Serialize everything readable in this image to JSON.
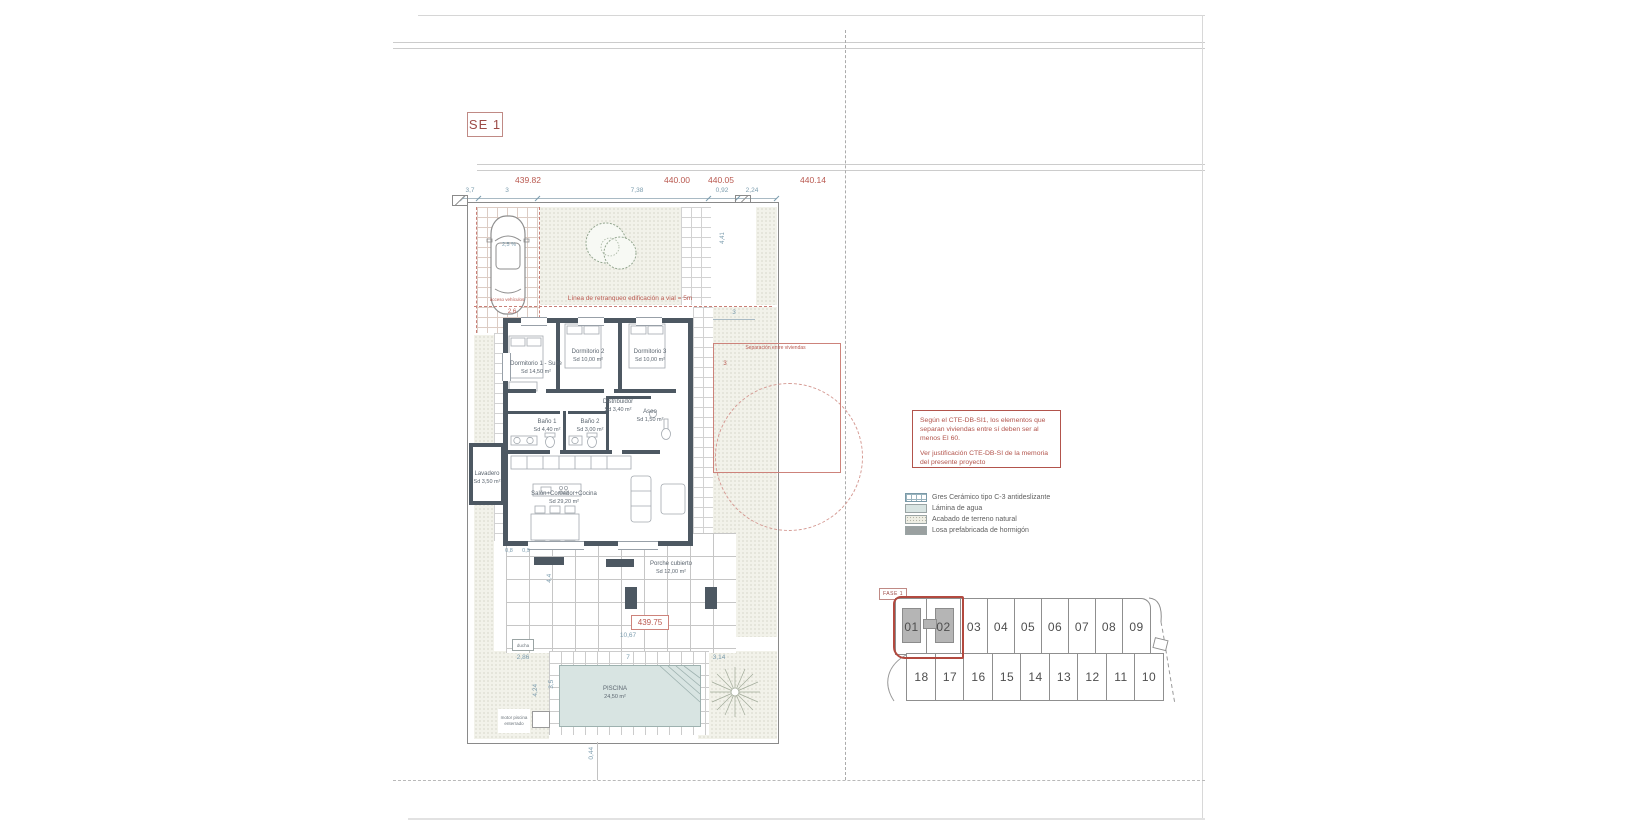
{
  "sheet": {
    "tag": "SE 1"
  },
  "dims": {
    "elevations": [
      "439.82",
      "440.00",
      "440.05",
      "440.14"
    ],
    "segments": [
      "3,7",
      "3",
      "7,38",
      "0,92",
      "2,24"
    ],
    "top_strip_height": "4,41",
    "slope_right": "4,8 %",
    "car_slope": "2,5 %",
    "car_width": "2,6",
    "offset_blue": "3",
    "offset_red": "3",
    "left_a": "0,8",
    "left_b": "0,9",
    "terrace_width": "10,67",
    "terrace_height": "4,4",
    "pool_width": "7",
    "deck_left": "2,86",
    "deck_right": "3,14",
    "pool_height": "3,5",
    "deck_height": "4,24",
    "plot_bottom": "0,44"
  },
  "annotations": {
    "retranqueo": "Línea de retranqueo edificación a vial = 5m",
    "separacion": "Separación entre viviendas",
    "acceso": "acceso vehículos",
    "terrace_level": "439.75",
    "ducha": "ducha",
    "motor": "motor piscina enterrado"
  },
  "rooms": {
    "dorm1": {
      "name": "Dormitorio 1 - Suite",
      "area": "Sd 14,50 m²"
    },
    "dorm2": {
      "name": "Dormitorio 2",
      "area": "Sd 10,00 m²"
    },
    "dorm3": {
      "name": "Dormitorio 3",
      "area": "Sd 10,00 m²"
    },
    "distribuidor": {
      "name": "Distribuidor",
      "area": "Sd 3,40 m²"
    },
    "bano1": {
      "name": "Baño 1",
      "area": "Sd 4,40 m²"
    },
    "bano2": {
      "name": "Baño 2",
      "area": "Sd 3,00 m²"
    },
    "aseo": {
      "name": "Aseo",
      "area": "Sd 1,50 m²"
    },
    "lavadero": {
      "name": "Lavadero",
      "area": "Sd 3,50 m²"
    },
    "salon": {
      "name": "Salón+Comedor+Cocina",
      "area": "Sd 29,20 m²"
    },
    "porche": {
      "name": "Porche cubierto",
      "area": "Sd 12,00 m²"
    },
    "piscina": {
      "name": "PISCINA",
      "area": "24,50 m²"
    }
  },
  "note_box": {
    "para1": "Según el CTE-DB-SI1, los elementos que separan viviendas entre sí deben ser al menos EI 60.",
    "para2": "Ver justificación CTE-DB-SI de la memoria del presente proyecto"
  },
  "legend": {
    "items": [
      {
        "label": "Gres Cerámico tipo C-3 antideslizante"
      },
      {
        "label": "Lámina de agua"
      },
      {
        "label": "Acabado de terreno natural"
      },
      {
        "label": "Losa prefabricada de hormigón"
      }
    ]
  },
  "siteplan": {
    "phase_tag": "FASE 1",
    "top_row": [
      "01",
      "02",
      "03",
      "04",
      "05",
      "06",
      "07",
      "08",
      "09"
    ],
    "bottom_row": [
      "18",
      "17",
      "16",
      "15",
      "14",
      "13",
      "12",
      "11",
      "10"
    ]
  },
  "colors": {
    "accent_red": "#b0534b",
    "dim_teal": "#7b9cae",
    "wall": "#4d5862",
    "pool": "#d8e4e2"
  }
}
